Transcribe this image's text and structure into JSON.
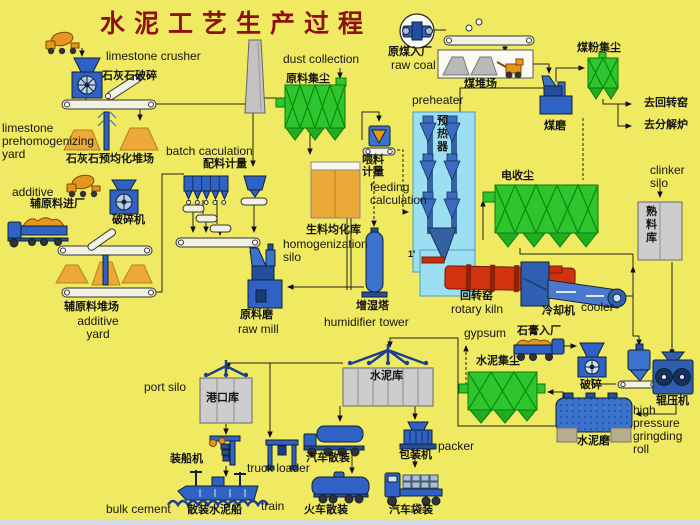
{
  "title": "水泥工艺生产过程",
  "colors": {
    "background": "#f0ea62",
    "machine_blue": "#2f62c4",
    "collector_green": "#2fc52f",
    "kiln_red": "#d2330f",
    "silo_orange": "#eca937",
    "structure_grey": "#cdcdcd",
    "title_red": "#8e1111"
  },
  "icons": [
    "mixer-truck-icon",
    "crusher-icon",
    "conveyor-icon",
    "stockpile-icon",
    "dust-collector-icon",
    "chimney-icon",
    "silo-icon",
    "hopper-icon",
    "mill-icon",
    "preheater-cyclone-icon",
    "rotary-kiln-icon",
    "cooler-icon",
    "truck-icon",
    "train-wagon-icon",
    "ship-icon",
    "gantry-loader-icon",
    "roller-press-icon",
    "packer-icon"
  ],
  "labels": {
    "limestone_crusher_en": "limestone crusher",
    "limestone_crusher_cn": "石灰石破碎",
    "limestone_yard_en": "limestone\nprehomogenizing\nyard",
    "limestone_yard_cn": "石灰石预均化堆场",
    "additive_en": "additive",
    "additive_entry_cn": "辅原料进厂",
    "crusher_cn": "破碎机",
    "additive_yard_cn": "辅原料堆场",
    "additive_yard_en": "additive\nyard",
    "batch_en": "batch caculation",
    "batch_cn": "配料计量",
    "raw_mill_cn": "原料磨",
    "raw_mill_en": "raw mill",
    "dust_collection_en": "dust collection",
    "raw_meal_dust_cn": "原料集尘",
    "homo_silo_cn": "生料均化库",
    "homo_silo_en": "homogenization\nsilo",
    "feeding_cn": "喂料\n计量",
    "feeding_en": "feeding\ncalculation",
    "humidifier_cn": "增湿塔",
    "humidifier_en": "humidifier tower",
    "preheater_en": "preheater",
    "preheater_cn": "预\n热\n器",
    "raw_coal_cn": "原煤入厂",
    "raw_coal_en": "raw coal",
    "coal_yard_cn": "煤堆场",
    "coal_mill_cn": "煤磨",
    "coal_dust_cn": "煤粉集尘",
    "to_rotary_kiln_cn": "去回转窑",
    "to_calciner_cn": "去分解炉",
    "esp_cn": "电收尘",
    "clinker_silo_en": "clinker\nsilo",
    "clinker_silo_cn": "熟\n料\n库",
    "rotary_kiln_cn": "回转窑",
    "rotary_kiln_en": "rotary kiln",
    "cooler_cn": "冷却机",
    "cooler_en": "cooler",
    "gypsum_en": "gypsum",
    "gypsum_cn": "石膏入厂",
    "cement_dust_cn": "水泥集尘",
    "crushing_cn": "破碎",
    "roller_press_cn": "辊压机",
    "hp_roll_en": "high\npressure\ngringding\nroll",
    "cement_mill_cn": "水泥磨",
    "cement_silo_cn": "水泥库",
    "packer_cn": "包装机",
    "packer_en": "packer",
    "truck_bulk_cn": "汽车散装",
    "truck_loader_en": "truck loader",
    "train_en": "train",
    "train_bulk_cn": "火车散装",
    "truck_bag_cn": "汽车袋装",
    "port_silo_en": "port silo",
    "port_silo_cn": "港口库",
    "ship_loader_cn": "装船机",
    "bulk_cement_en": "bulk cement",
    "bulk_ship_cn": "散装水泥船",
    "tick_mark": "1′"
  }
}
